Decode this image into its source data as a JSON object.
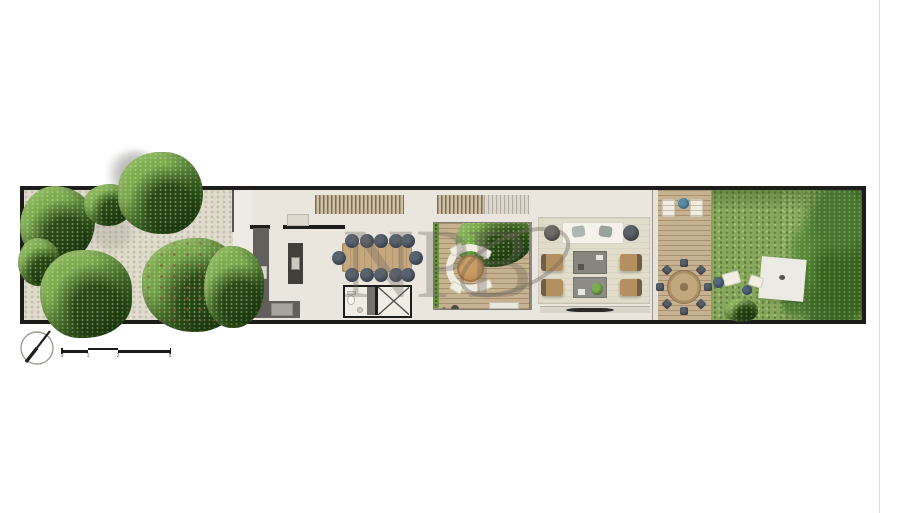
{
  "title": "linear-house-ground-floor-plan",
  "watermark": {
    "letters": [
      "N",
      "P",
      "B"
    ],
    "color": "rgba(112,106,96,0.35)"
  },
  "scale_bar": {
    "labels": [
      "0",
      "1",
      "2",
      "5"
    ]
  },
  "compass": {
    "type": "north-arrow"
  },
  "palette": {
    "wall": "#1d1d1b",
    "floor": "#eae6dd",
    "gravel": "#e0dcce",
    "deck_wood": "#c6b190",
    "lawn": "#87a75c",
    "foliage": "#4d7c32",
    "dining_chair": "#39424e",
    "armchair_tan": "#b3905f",
    "counter_gray": "#605f59",
    "table_wood": "#c6a87e",
    "accent_blue_table": "#3d6a85"
  },
  "zones": [
    "front-garden-gravel",
    "entry-path",
    "kitchen",
    "entry-hall",
    "stairs",
    "dining-area",
    "wc",
    "elevator",
    "courtyard-deck",
    "living-room",
    "rear-deck",
    "back-lawn-garden"
  ],
  "furniture": [
    "kitchen-L-counter",
    "kitchen-island",
    "entry-bench",
    "dining-table",
    "dining-chairs-x12",
    "toilet",
    "elevator-cab",
    "curved-lounge-sofa",
    "round-coffee-table",
    "sofa",
    "round-side-tables-x2",
    "armchairs-x4",
    "coffee-tables-x2",
    "indoor-plant",
    "tv-console",
    "sun-loungers-x2",
    "blue-side-table",
    "round-patio-table",
    "patio-chairs-x8",
    "picnic-blanket",
    "floor-cushions-x2",
    "poufs-x2",
    "bbq-grill",
    "garden-bench"
  ]
}
